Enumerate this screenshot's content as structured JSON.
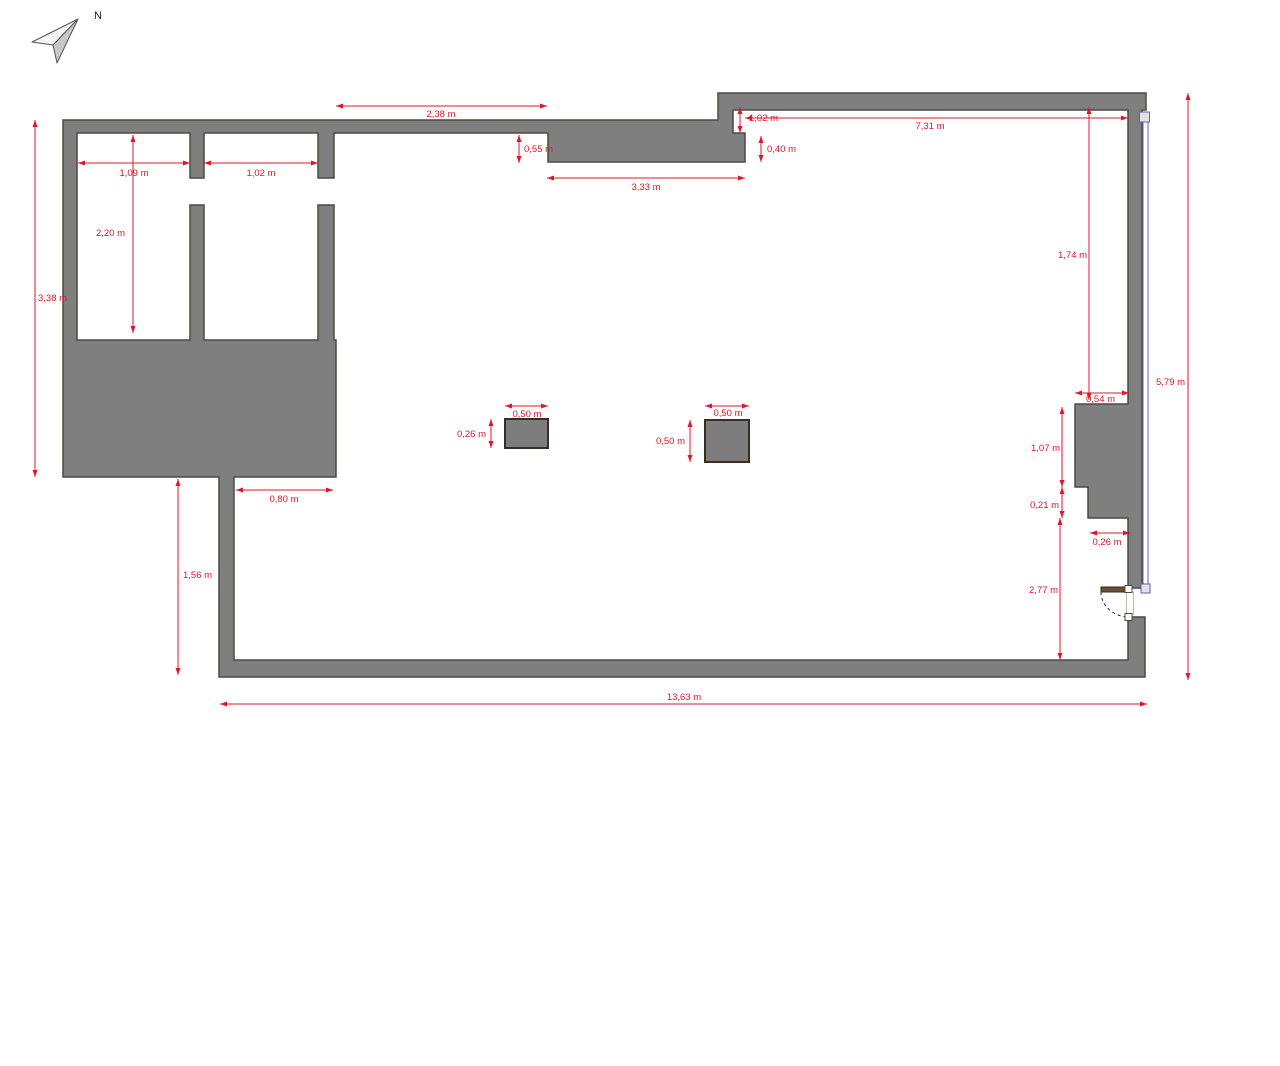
{
  "compass": {
    "north_label": "N"
  },
  "colors": {
    "wall_fill": "#7f7f7f",
    "wall_stroke": "#4d4a44",
    "dimension_red": "#e0162b",
    "window_blue": "#5b5bcf",
    "door_brown": "#6a4e37"
  },
  "dims": {
    "top_span": "2,38 m",
    "top_step": "1,02 m",
    "top_right_span": "7,31 m",
    "recess_depth_left": "0,55 m",
    "recess_depth_right": "0,40 m",
    "recess_width": "3,33 m",
    "room1_width": "1,09 m",
    "room2_width": "1,02 m",
    "room_depth": "2,20 m",
    "left_height": "3,38 m",
    "right_upper_height": "1,74 m",
    "right_total_height": "5,79 m",
    "pier_width": "0,54 m",
    "pier_upper_height": "1,07 m",
    "pier_step_height": "0,21 m",
    "pier_lower_width": "0,26 m",
    "door_wall_height": "2,77 m",
    "passage_width": "0,80 m",
    "lower_wall_height": "1,56 m",
    "bottom_total_width": "13,63 m",
    "col1_width": "0,50 m",
    "col1_height": "0,26 m",
    "col2_width": "0,50 m",
    "col2_height": "0,50 m"
  }
}
